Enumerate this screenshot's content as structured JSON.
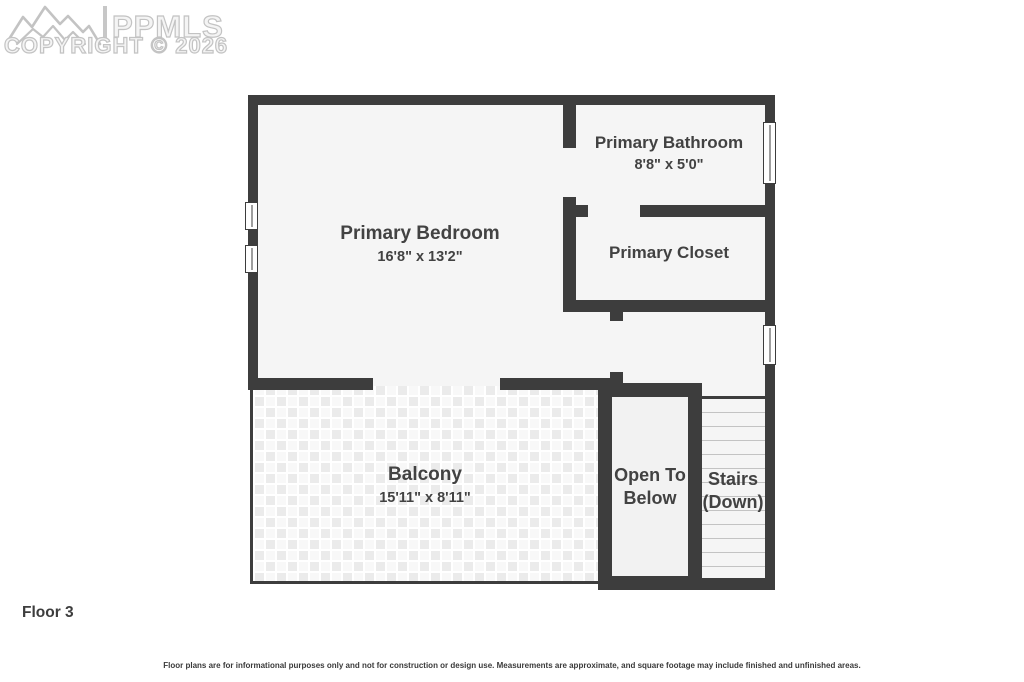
{
  "watermark": {
    "logo_icon": "mountain-range",
    "logo_text": "PPMLS",
    "copyright_line": "COPYRIGHT © 2026"
  },
  "floor_label": "Floor 3",
  "rooms": {
    "bedroom": {
      "name": "Primary Bedroom",
      "dims": "16'8\" x 13'2\""
    },
    "bathroom": {
      "name": "Primary Bathroom",
      "dims": "8'8\" x 5'0\""
    },
    "closet": {
      "name": "Primary Closet"
    },
    "balcony": {
      "name": "Balcony",
      "dims": "15'11\" x 8'11\""
    },
    "open_to_below": {
      "line1": "Open To",
      "line2": "Below"
    },
    "stairs": {
      "line1": "Stairs",
      "line2": "(Down)"
    }
  },
  "disclaimer": "Floor plans are for informational purposes only and not for construction or design use. Measurements are approximate, and square footage may include finished and unfinished areas.",
  "colors": {
    "wall": "#3d3d3d",
    "room_fill": "#f5f5f5",
    "label_text": "#424242",
    "watermark": "#c3c3c3",
    "stair_tread": "#c3c3c3"
  }
}
